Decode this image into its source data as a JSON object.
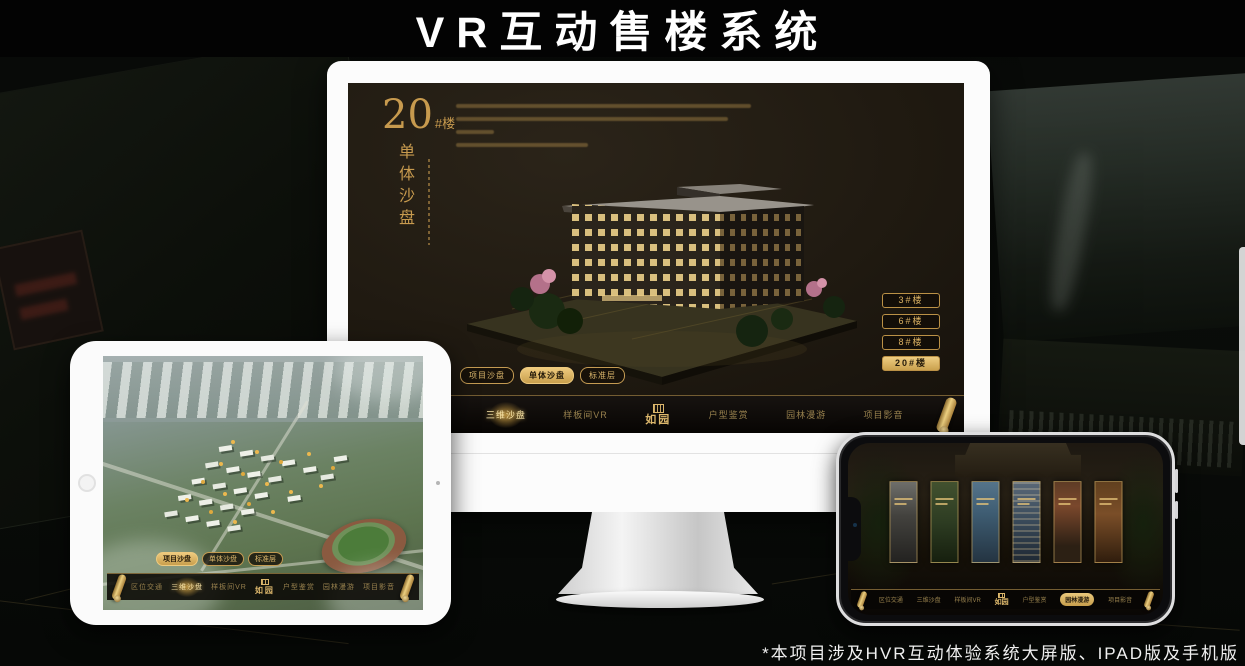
{
  "accent_gold": "#d2ab62",
  "page": {
    "title": "VR互动售楼系统",
    "footnote": "*本项目涉及HVR互动体验系统大屏版、IPAD版及手机版"
  },
  "monitor_app": {
    "headline": {
      "number": "20",
      "suffix": "#楼",
      "vertical": "单体沙盘"
    },
    "floor_buttons": [
      {
        "label": "3#楼",
        "active": false
      },
      {
        "label": "6#楼",
        "active": false
      },
      {
        "label": "8#楼",
        "active": false
      },
      {
        "label": "20#楼",
        "active": true
      }
    ],
    "sub_tabs": [
      {
        "label": "项目沙盘",
        "active": false
      },
      {
        "label": "单体沙盘",
        "active": true
      },
      {
        "label": "标准层",
        "active": false
      }
    ],
    "nav_left": [
      {
        "label": "区位交通",
        "active": false
      },
      {
        "label": "三维沙盘",
        "active": true
      },
      {
        "label": "样板间VR",
        "active": false
      }
    ],
    "logo": "如园",
    "nav_right": [
      {
        "label": "户型鉴赏",
        "active": false
      },
      {
        "label": "园林漫游",
        "active": false
      },
      {
        "label": "项目影音",
        "active": false
      }
    ]
  },
  "tablet_app": {
    "sub_tabs": [
      {
        "label": "项目沙盘",
        "active": true
      },
      {
        "label": "单体沙盘",
        "active": false
      },
      {
        "label": "标准层",
        "active": false
      }
    ],
    "nav_left": [
      {
        "label": "区位交通",
        "active": false
      },
      {
        "label": "三维沙盘",
        "active": true
      },
      {
        "label": "样板间VR",
        "active": false
      }
    ],
    "logo": "如园",
    "nav_right": [
      {
        "label": "户型鉴赏",
        "active": false
      },
      {
        "label": "园林漫游",
        "active": false
      },
      {
        "label": "项目影音",
        "active": false
      }
    ]
  },
  "phone_app": {
    "nav_left": [
      {
        "label": "区位交通",
        "active": false
      },
      {
        "label": "三维沙盘",
        "active": false
      },
      {
        "label": "样板间VR",
        "active": false
      }
    ],
    "logo": "如园",
    "nav_right": [
      {
        "label": "户型鉴赏",
        "active": false
      },
      {
        "label": "园林漫游",
        "active": true
      },
      {
        "label": "项目影音",
        "active": false
      }
    ]
  }
}
